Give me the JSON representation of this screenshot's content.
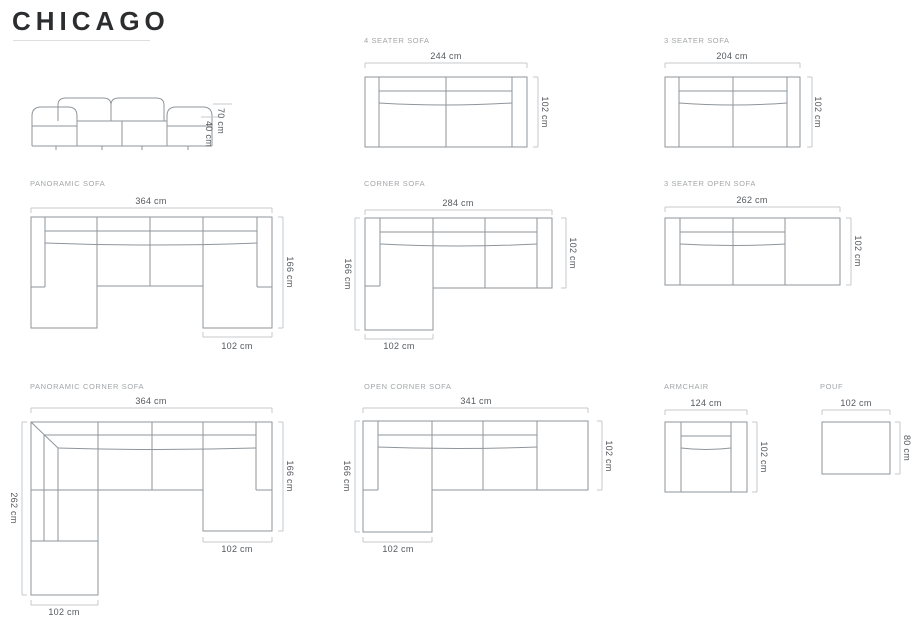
{
  "title": "CHICAGO",
  "front_view": {
    "total_height": "70 cm",
    "seat_height": "40 cm"
  },
  "sections": {
    "four_seater": {
      "label": "4 SEATER SOFA",
      "width": "244 cm",
      "depth": "102 cm"
    },
    "three_seater": {
      "label": "3 SEATER SOFA",
      "width": "204 cm",
      "depth": "102 cm"
    },
    "panoramic": {
      "label": "PANORAMIC SOFA",
      "width": "364 cm",
      "depth": "166 cm",
      "chaise_width": "102 cm"
    },
    "corner": {
      "label": "CORNER SOFA",
      "width": "284 cm",
      "depth_total": "166 cm",
      "depth_body": "102 cm",
      "chaise_width": "102 cm"
    },
    "three_seater_open": {
      "label": "3 SEATER OPEN SOFA",
      "width": "262 cm",
      "depth": "102 cm"
    },
    "panoramic_corner": {
      "label": "PANORAMIC CORNER SOFA",
      "width": "364 cm",
      "height_left": "262 cm",
      "height_right": "166 cm",
      "chaise_right_width": "102 cm",
      "chaise_bottom_width": "102 cm"
    },
    "open_corner": {
      "label": "OPEN CORNER SOFA",
      "width": "341 cm",
      "depth_total": "166 cm",
      "depth_body": "102 cm",
      "chaise_width": "102 cm"
    },
    "armchair": {
      "label": "ARMCHAIR",
      "width": "124 cm",
      "depth": "102 cm"
    },
    "pouf": {
      "label": "POUF",
      "width": "102 cm",
      "depth": "80 cm"
    }
  },
  "colors": {
    "outline": "#8f959a",
    "dimension_line": "#c4c8cb",
    "section_label": "#a2a6a9",
    "dimension_text": "#54585d",
    "title_text": "#2b2d2f",
    "background": "#ffffff"
  }
}
